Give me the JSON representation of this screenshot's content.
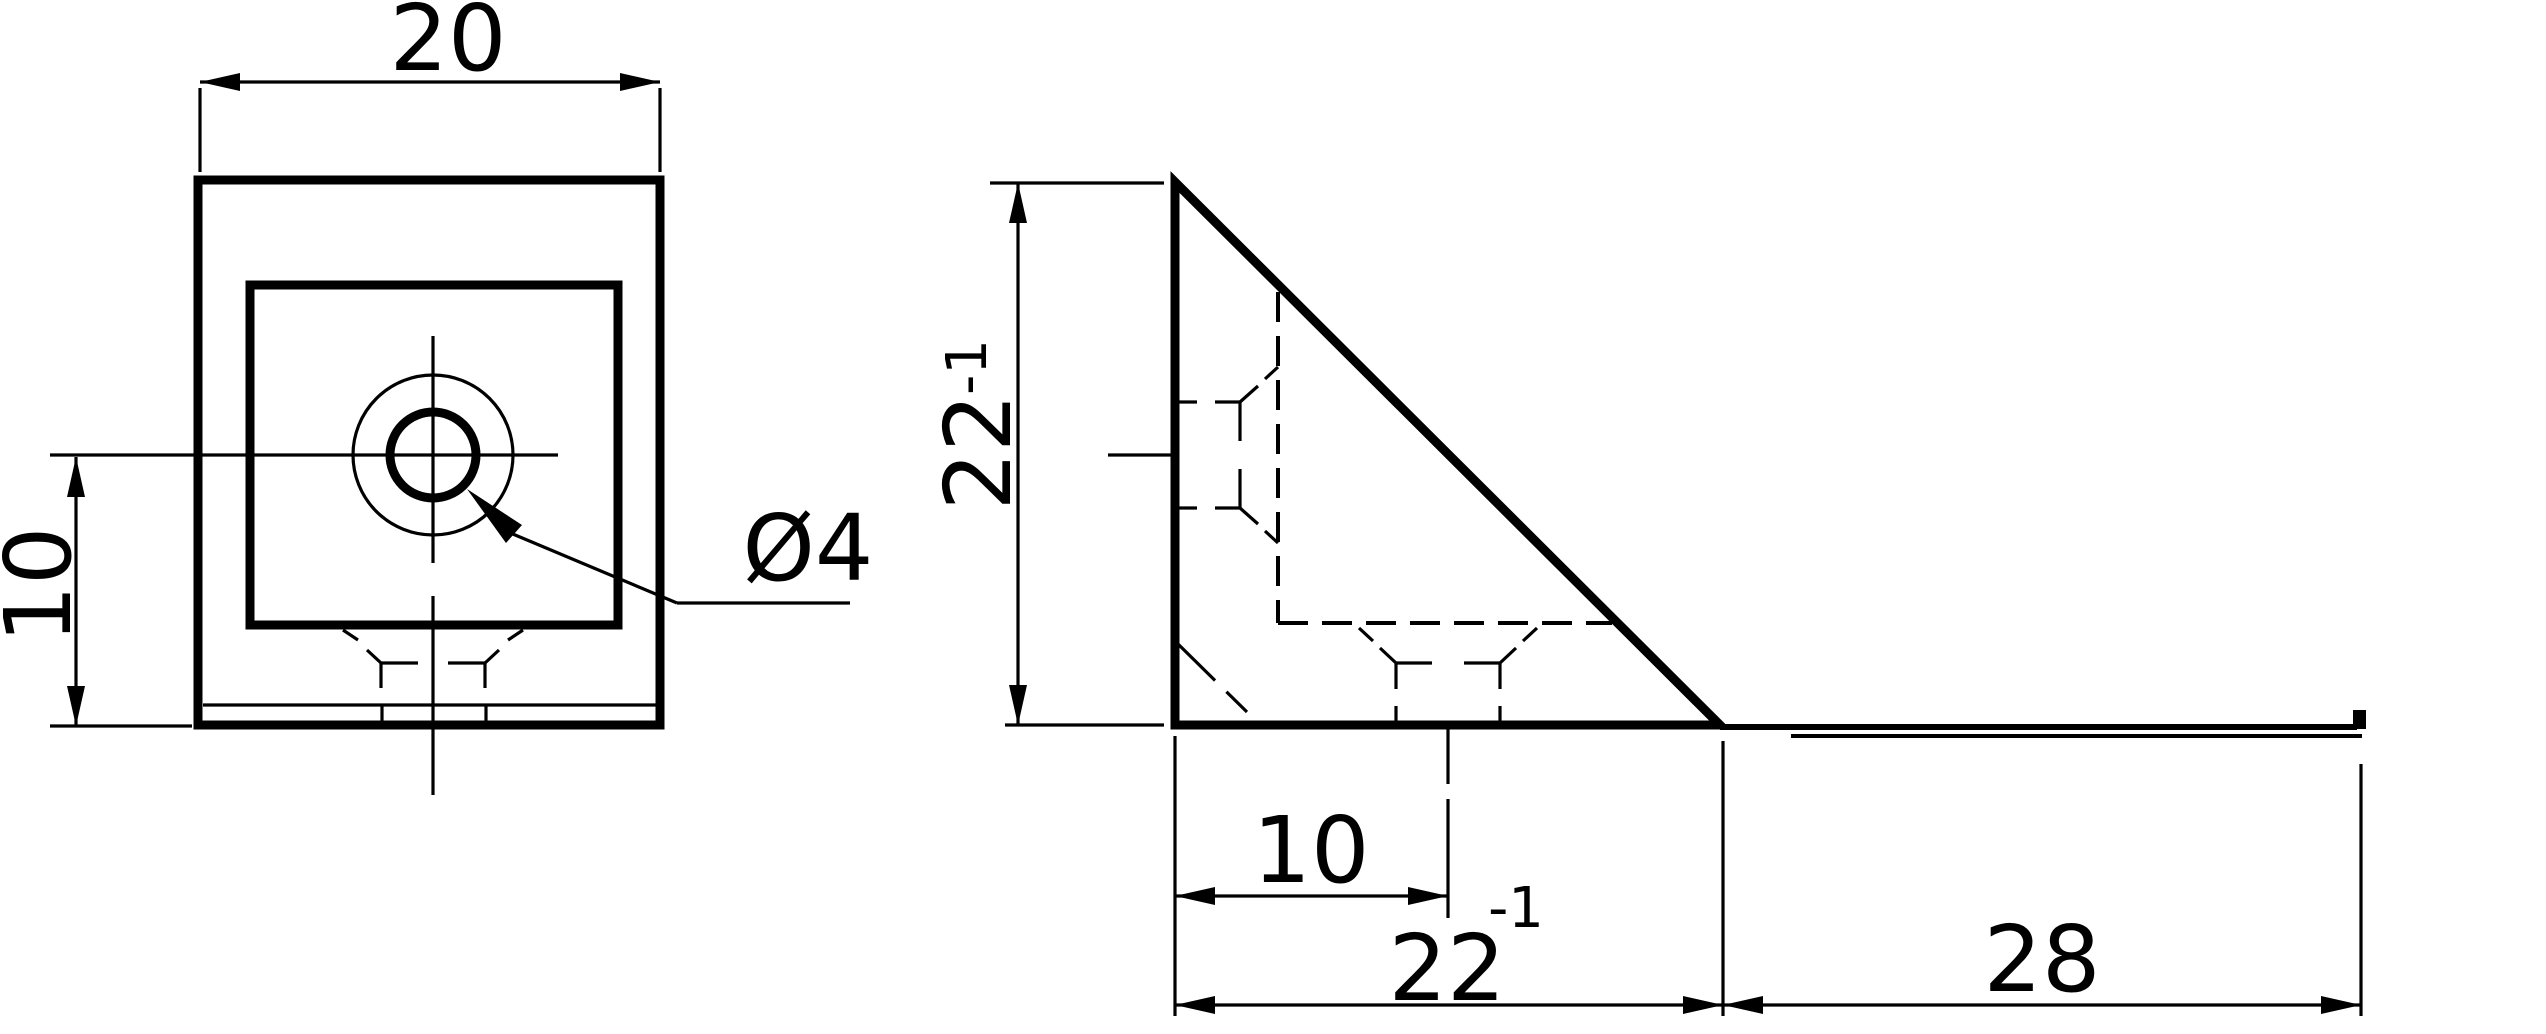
{
  "page": {
    "background": "#ffffff",
    "ink": "#000000",
    "description": "Two-view technical drawing of a corner bracket"
  },
  "front_view": {
    "dims": {
      "width": {
        "label": "20"
      },
      "offset": {
        "label": "10"
      }
    },
    "callouts": {
      "hole": {
        "label": "Ø4"
      }
    }
  },
  "side_view": {
    "dims": {
      "height": {
        "label": "22",
        "tol": "-1"
      },
      "slot_offset": {
        "label": "10"
      },
      "depth": {
        "label": "22",
        "tol": "-1"
      },
      "flange": {
        "label": "28"
      }
    }
  }
}
